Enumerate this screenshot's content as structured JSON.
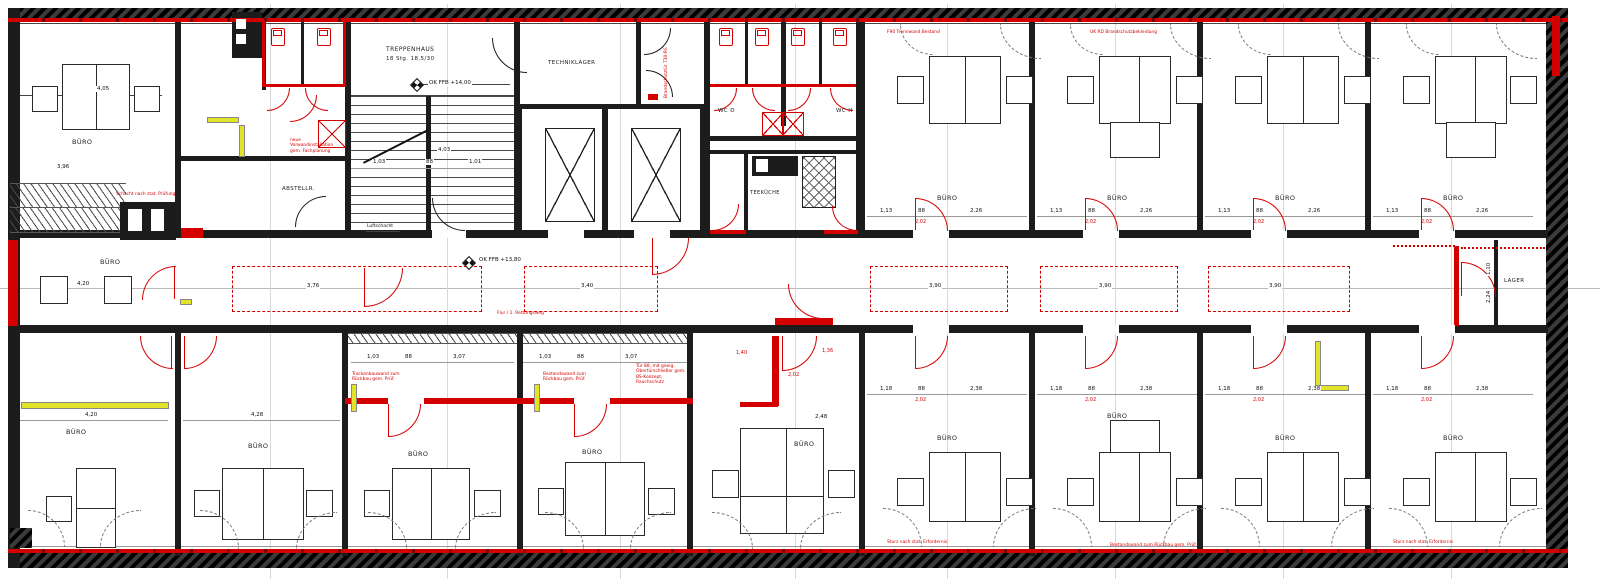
{
  "colors": {
    "accent_red": "#d40000",
    "demolition_yellow": "#e3e32a",
    "wall_black": "#1c1c1c"
  },
  "levels": {
    "stair": "OK FFB +14,00",
    "corridor": "OK FFB +13,80"
  },
  "stair": {
    "label": "TREPPENHAUS",
    "steps": "18 Stg. 18,5/30",
    "dim_depth": "4,03",
    "dim_left": "1,03",
    "dim_door": "88",
    "dim_right": "1,01"
  },
  "corridor": {
    "zones": [
      {
        "dim": "3,76"
      },
      {
        "dim": "3,40"
      },
      {
        "dim": "3,90"
      },
      {
        "dim": "3,90"
      },
      {
        "dim": "3,90"
      }
    ],
    "note": "Flur / 1. Rettungsweg",
    "luftschacht": "Luftschacht",
    "red_dims": [
      "1,40",
      "2,02",
      "1,36"
    ]
  },
  "rooms": {
    "top_left": {
      "label": "BÜRO",
      "dim_a": "4,05",
      "dim_b": "3,96"
    },
    "mid_left": {
      "label": "BÜRO",
      "dim": "4,20"
    },
    "bottom_left": {
      "label": "BÜRO",
      "dim": "4,20"
    },
    "bottom_left2": {
      "label": "BÜRO",
      "dim": "4,28"
    },
    "technik": {
      "label": "TECHNIKLAGER"
    },
    "abstell": {
      "label": "ABSTELLR."
    },
    "wc_d": {
      "label": "WC D"
    },
    "wc_h": {
      "label": "WC H"
    },
    "teekueche": {
      "label": "TEEKÜCHE"
    },
    "lager": {
      "label": "LAGER",
      "dim_a": "2,24",
      "dim_b": "1,10"
    },
    "top_right": [
      {
        "label": "BÜRO",
        "dim_a": "1,13",
        "dim_b": "88",
        "dim_c": "2,26",
        "dim_door": "2,02"
      },
      {
        "label": "BÜRO",
        "dim_a": "1,13",
        "dim_b": "88",
        "dim_c": "2,26",
        "dim_door": "2,02"
      },
      {
        "label": "BÜRO",
        "dim_a": "1,13",
        "dim_b": "88",
        "dim_c": "2,26",
        "dim_door": "2,02"
      },
      {
        "label": "BÜRO",
        "dim_a": "1,13",
        "dim_b": "88",
        "dim_c": "2,26",
        "dim_door": "2,02"
      }
    ],
    "bottom_mid": [
      {
        "label": "BÜRO",
        "dim_a": "1,03",
        "dim_b": "88",
        "dim_c": "3,07"
      },
      {
        "label": "BÜRO",
        "dim_a": "1,03",
        "dim_b": "88",
        "dim_c": "3,07"
      },
      {
        "label": "BÜRO",
        "dim_c": "2,48"
      }
    ],
    "bottom_right": [
      {
        "label": "BÜRO",
        "dim_a": "1,18",
        "dim_b": "88",
        "dim_c": "2,38",
        "dim_door": "2,02"
      },
      {
        "label": "BÜRO",
        "dim_a": "1,18",
        "dim_b": "88",
        "dim_c": "2,38",
        "dim_door": "2,02"
      },
      {
        "label": "BÜRO",
        "dim_a": "1,18",
        "dim_b": "88",
        "dim_c": "2,38",
        "dim_door": "2,02"
      },
      {
        "label": "BÜRO",
        "dim_a": "1,18",
        "dim_b": "88",
        "dim_c": "2,38",
        "dim_door": "2,02"
      }
    ]
  },
  "annotations": {
    "top_wall_1": "F90 Trennwand Bestand",
    "top_wall_2": "UK RD Brandschutzbekleidung",
    "vestibule_door": "Brandschutztür T30-RS",
    "shaft_block_note": "Schacht nach stat. Prüfung",
    "wc_note": "neue Vorwandinstallation gem. Fachplanung",
    "demo_note_1": "Trockenbauwand zum Rückbau gem. Prüf.",
    "demo_note_2": "Bestandswand zum Rückbau gem. Prüf.",
    "door_note": "Tür 88, mit geeig. Obertürschließer gem. BS-Konzept, Rauchschutz",
    "bottom_wall_note": "Sturz nach stat. Erfordernis"
  }
}
